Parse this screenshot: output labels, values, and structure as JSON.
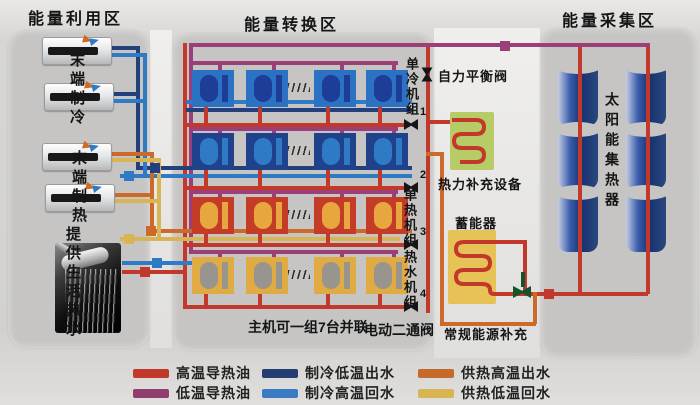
{
  "zones": {
    "utilization": {
      "title": "能量利用区",
      "terminal_cooling": "末端制冷",
      "terminal_heating": "末端制热",
      "domestic_hot_water": "提供生活热水"
    },
    "conversion": {
      "title": "能量转换区",
      "cooling_units": "单冷机组",
      "heating_units": "单热机组",
      "hot_water_units": "热水机组",
      "balance_valve": "自力平衡阀",
      "thermal_supplement": "热力补充设备",
      "accumulator": "蓄能器",
      "conventional_energy": "常规能源补充",
      "parallel_note": "主机可一组7台并联",
      "motor_valve": "电动二通阀",
      "valve_numbers": [
        "1",
        "2",
        "3",
        "4"
      ]
    },
    "collection": {
      "title": "能量采集区",
      "collector_label": "太阳能集热器"
    }
  },
  "legend": {
    "items": [
      {
        "label": "高温导热油",
        "color": "#c2392b"
      },
      {
        "label": "低温导热油",
        "color": "#8f3e6d"
      },
      {
        "label": "制冷低温出水",
        "color": "#243e72"
      },
      {
        "label": "制冷高温回水",
        "color": "#3a7cc3"
      },
      {
        "label": "供热高温出水",
        "color": "#c56a2b"
      },
      {
        "label": "供热低温回水",
        "color": "#d8b452"
      }
    ]
  }
}
